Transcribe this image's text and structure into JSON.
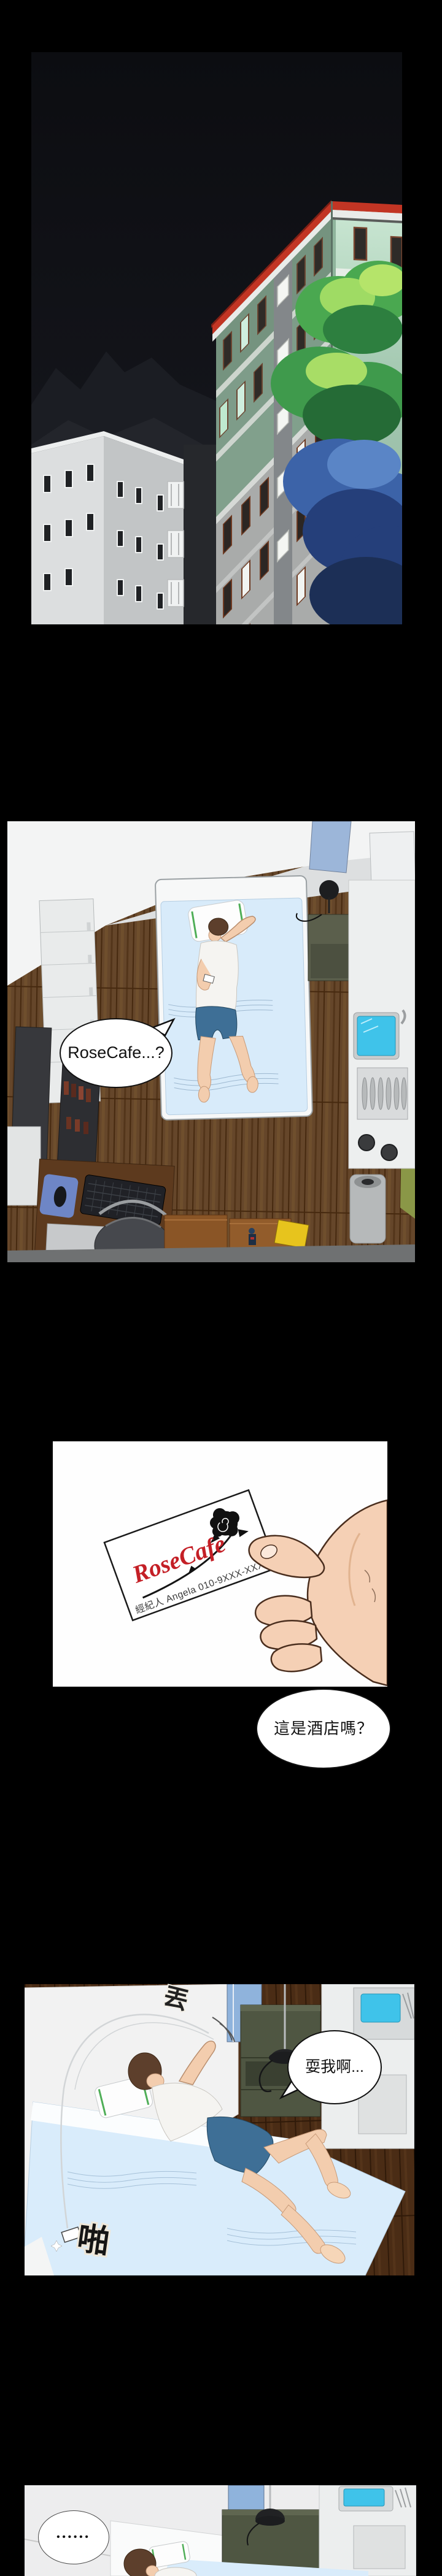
{
  "speech": {
    "p2": {
      "text": "RoseCafe...?"
    },
    "p3": {
      "text": "這是酒店嗎？"
    },
    "p4": {
      "text": "耍我啊..."
    },
    "p5": {
      "text": "••••••"
    }
  },
  "sfx": {
    "throw": {
      "text": "丟"
    },
    "slap": {
      "text": "啪"
    }
  },
  "card": {
    "brand": "RoseCafe",
    "contact": "經紀人 Angela 010-9XXX-XXXX"
  },
  "palette": {
    "page_background": "#000000",
    "night_sky": "#101118",
    "building_green": "#7E9C89",
    "building_mint": "#A6CAB3",
    "roof_red": "#C23524",
    "facade_gray": "#A9ABAA",
    "white_building": "#DCDEDF",
    "tree_green": "#3F9A4C",
    "tree_highlight": "#A8DD66",
    "tree_blue": "#3C63A8",
    "wood_floor": "#65462A",
    "wood_floor_dark": "#4A2C15",
    "bedding_blue": "#D8EBFA",
    "pillow_stripe_green": "#4FAE57",
    "sink_water": "#3FC3EA",
    "kitchen_wall_green": "#8A9747",
    "window_door_blue": "#8FB3DC",
    "skin": "#F3CDAE",
    "hair_brown": "#5D3F2C",
    "shorts_blue": "#3E6F96",
    "card_brand_red": "#C41F26",
    "speech_text": "#111111"
  }
}
